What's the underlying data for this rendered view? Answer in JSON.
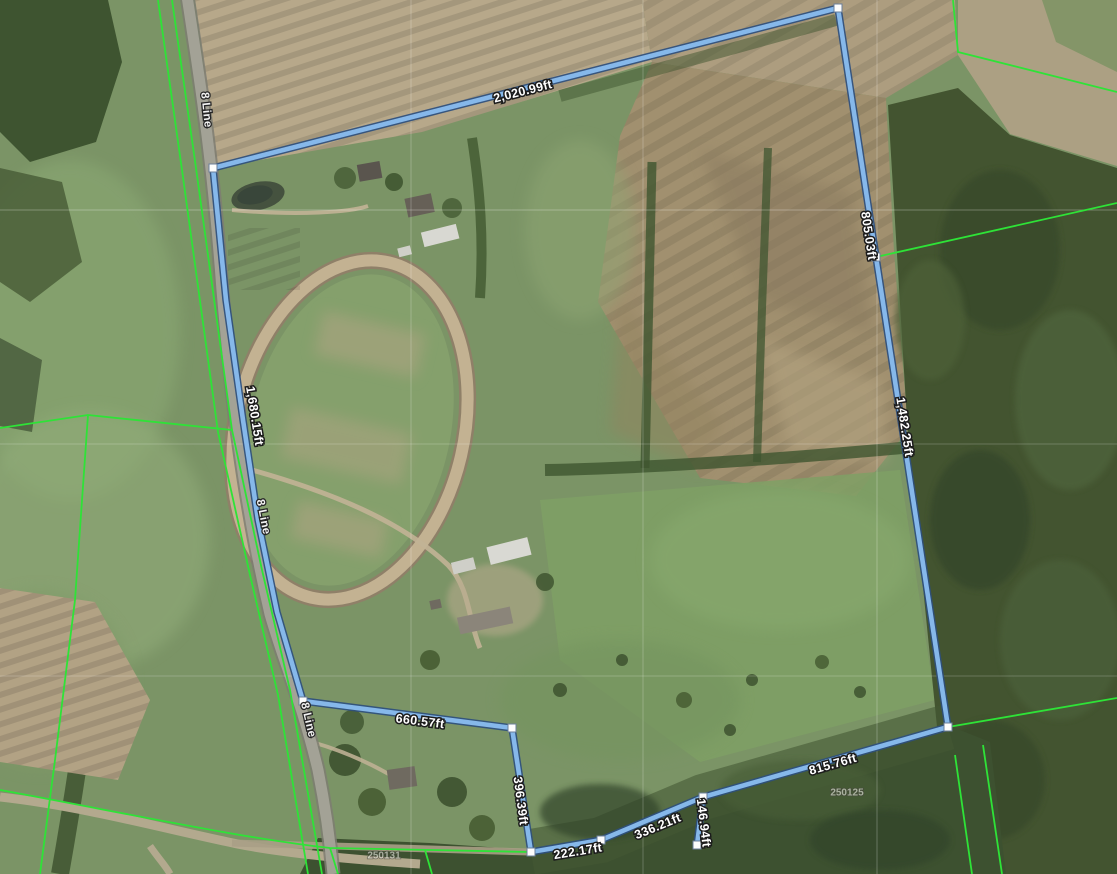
{
  "map": {
    "type": "aerial-parcel-measurement-view",
    "road_labels": [
      "8 Line",
      "8 Line",
      "8 Line"
    ],
    "parcel_ghost_labels": [
      "250125",
      "250131"
    ],
    "boundary": {
      "stroke_color": "#86b8ea",
      "casing_color": "#2e4f7d",
      "vertex_fill": "#ffffff",
      "segment_labels": {
        "top": "2,020.99ft",
        "upper_right": "805.03ft",
        "right": "1,482.25ft",
        "lower_right": "815.76ft",
        "spur": "146.94ft",
        "bottom_diagonal": "336.21ft",
        "bottom": "222.17ft",
        "bottom_left_vertical": "396.39ft",
        "bottom_left_horizontal": "660.57ft",
        "west_along_road": "1,680.15ft"
      }
    },
    "parcel_line_color": "#2ee337",
    "label_text_color": "#ffffff",
    "label_outline_color": "#1c1c1c"
  }
}
